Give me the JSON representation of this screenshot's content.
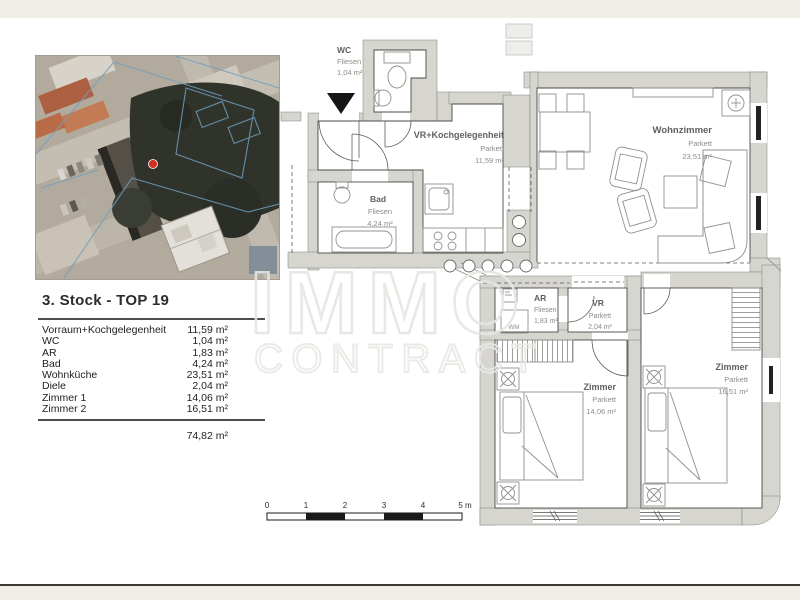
{
  "page": {
    "title": "3. Stock - TOP 19"
  },
  "table": {
    "rows": [
      {
        "label": "Vorraum+Kochgelegenheit",
        "area": "11,59 m²"
      },
      {
        "label": "WC",
        "area": "1,04 m²"
      },
      {
        "label": "AR",
        "area": "1,83 m²"
      },
      {
        "label": "Bad",
        "area": "4,24 m²"
      },
      {
        "label": "Wohnküche",
        "area": "23,51 m²"
      },
      {
        "label": "Diele",
        "area": "2,04 m²"
      },
      {
        "label": "Zimmer 1",
        "area": "14,06 m²"
      },
      {
        "label": "Zimmer 2",
        "area": "16,51 m²"
      }
    ],
    "total": "74,82 m²"
  },
  "plan": {
    "rooms": {
      "wc": {
        "name": "WC",
        "floor": "Fliesen",
        "area": "1,04 m²"
      },
      "vr_koch": {
        "name": "VR+Kochgelegenheit",
        "floor": "Parkett",
        "area": "11,59 m²"
      },
      "bad": {
        "name": "Bad",
        "floor": "Fliesen",
        "area": "4,24 m²"
      },
      "wohnzimmer": {
        "name": "Wohnzimmer",
        "floor": "Parkett",
        "area": "23,51 m²"
      },
      "ar": {
        "name": "AR",
        "floor": "Fliesen",
        "area": "1,83 m²"
      },
      "vr": {
        "name": "VR",
        "floor": "Parkett",
        "area": "2,04 m²"
      },
      "zimmer1": {
        "name": "Zimmer",
        "floor": "Parkett",
        "area": "14,06 m²"
      },
      "zimmer2": {
        "name": "Zimmer",
        "floor": "Parkett",
        "area": "16,51 m²"
      }
    },
    "appliance_label": "WM"
  },
  "scalebar": {
    "ticks": [
      "0",
      "1",
      "2",
      "3",
      "4",
      "5 m"
    ]
  },
  "watermark": {
    "line1": "IMMO",
    "line2": "CONTRACT"
  },
  "colors": {
    "wall_gray": "#d6d5d0",
    "page_margin": "#f1eee7",
    "marker_red": "#d32f23",
    "cadastral_blue": "#6f9fc0"
  }
}
